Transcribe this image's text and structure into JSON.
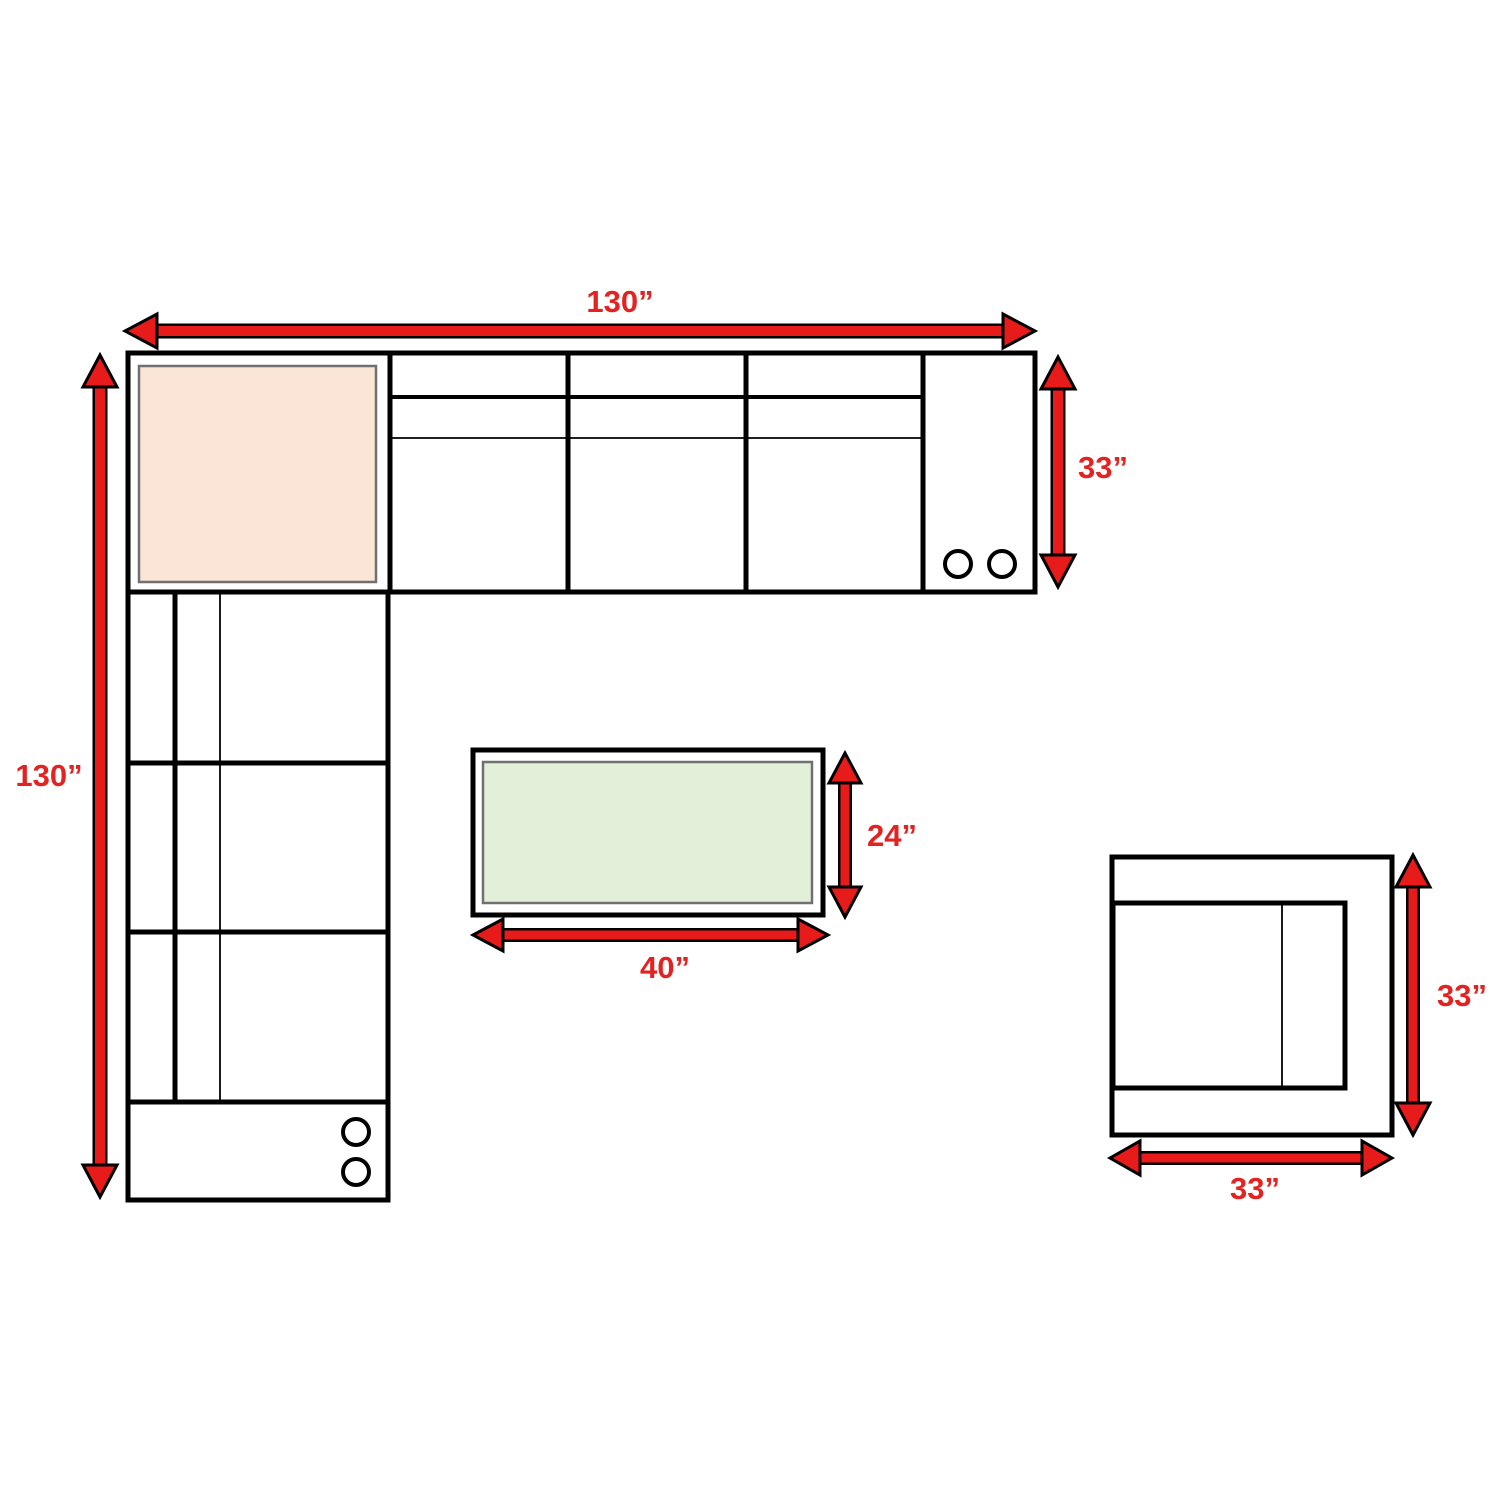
{
  "diagram": {
    "type": "furniture-dimension-plan",
    "colors": {
      "background": "#ffffff",
      "outline": "#000000",
      "arrow_red": "#e81b1b",
      "label_red": "#e32222",
      "corner_ottoman_fill": "#fbe5d6",
      "coffee_table_fill": "#e2efd9",
      "inner_border_gray": "#707070"
    },
    "labels": {
      "sectional_top_width": "130”",
      "sectional_right_depth": "33”",
      "sectional_left_length": "130”",
      "coffee_table_depth": "24”",
      "coffee_table_width": "40”",
      "chair_depth": "33”",
      "chair_width": "33”"
    }
  }
}
